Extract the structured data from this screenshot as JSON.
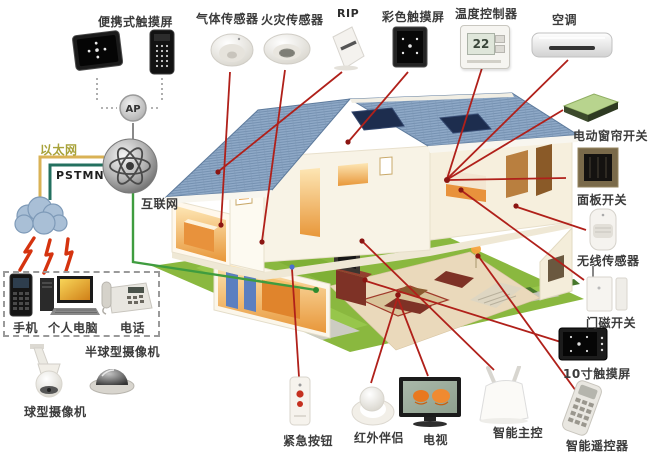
{
  "labels": {
    "portable_touchscreen": "便携式触摸屏",
    "gas_sensor": "气体传感器",
    "fire_sensor": "火灾传感器",
    "rip": "RIP",
    "color_touchscreen": "彩色触摸屏",
    "temperature_controller": "温度控制器",
    "air_conditioner": "空调",
    "curtain_switch": "电动窗帘开关",
    "panel_switch": "面板开关",
    "wireless_sensor": "无线传感器",
    "door_magnet_switch": "门磁开关",
    "touchscreen_10inch": "10寸触摸屏",
    "smart_remote": "智能遥控器",
    "smart_master_control": "智能主控",
    "tv": "电视",
    "ir_companion": "红外伴侣",
    "emergency_button": "紧急按钮",
    "ptz_camera": "球型摄像机",
    "dome_camera": "半球型摄像机",
    "mobile_phone": "手机",
    "personal_computer": "个人电脑",
    "telephone": "电话",
    "ethernet": "以太网",
    "pstn": "PSTMN",
    "internet": "互联网",
    "ap": "AP"
  },
  "values": {
    "thermostat_reading": "22"
  },
  "colors": {
    "connection_red": "#b0201a",
    "connection_green": "#3f9c3f",
    "ethernet_yellow": "#d9b255",
    "pstn_teal": "#23705f",
    "label_text": "#3b3b3b",
    "roof_blue": "#8fa9c7",
    "lawn_green": "#8ab83f"
  }
}
